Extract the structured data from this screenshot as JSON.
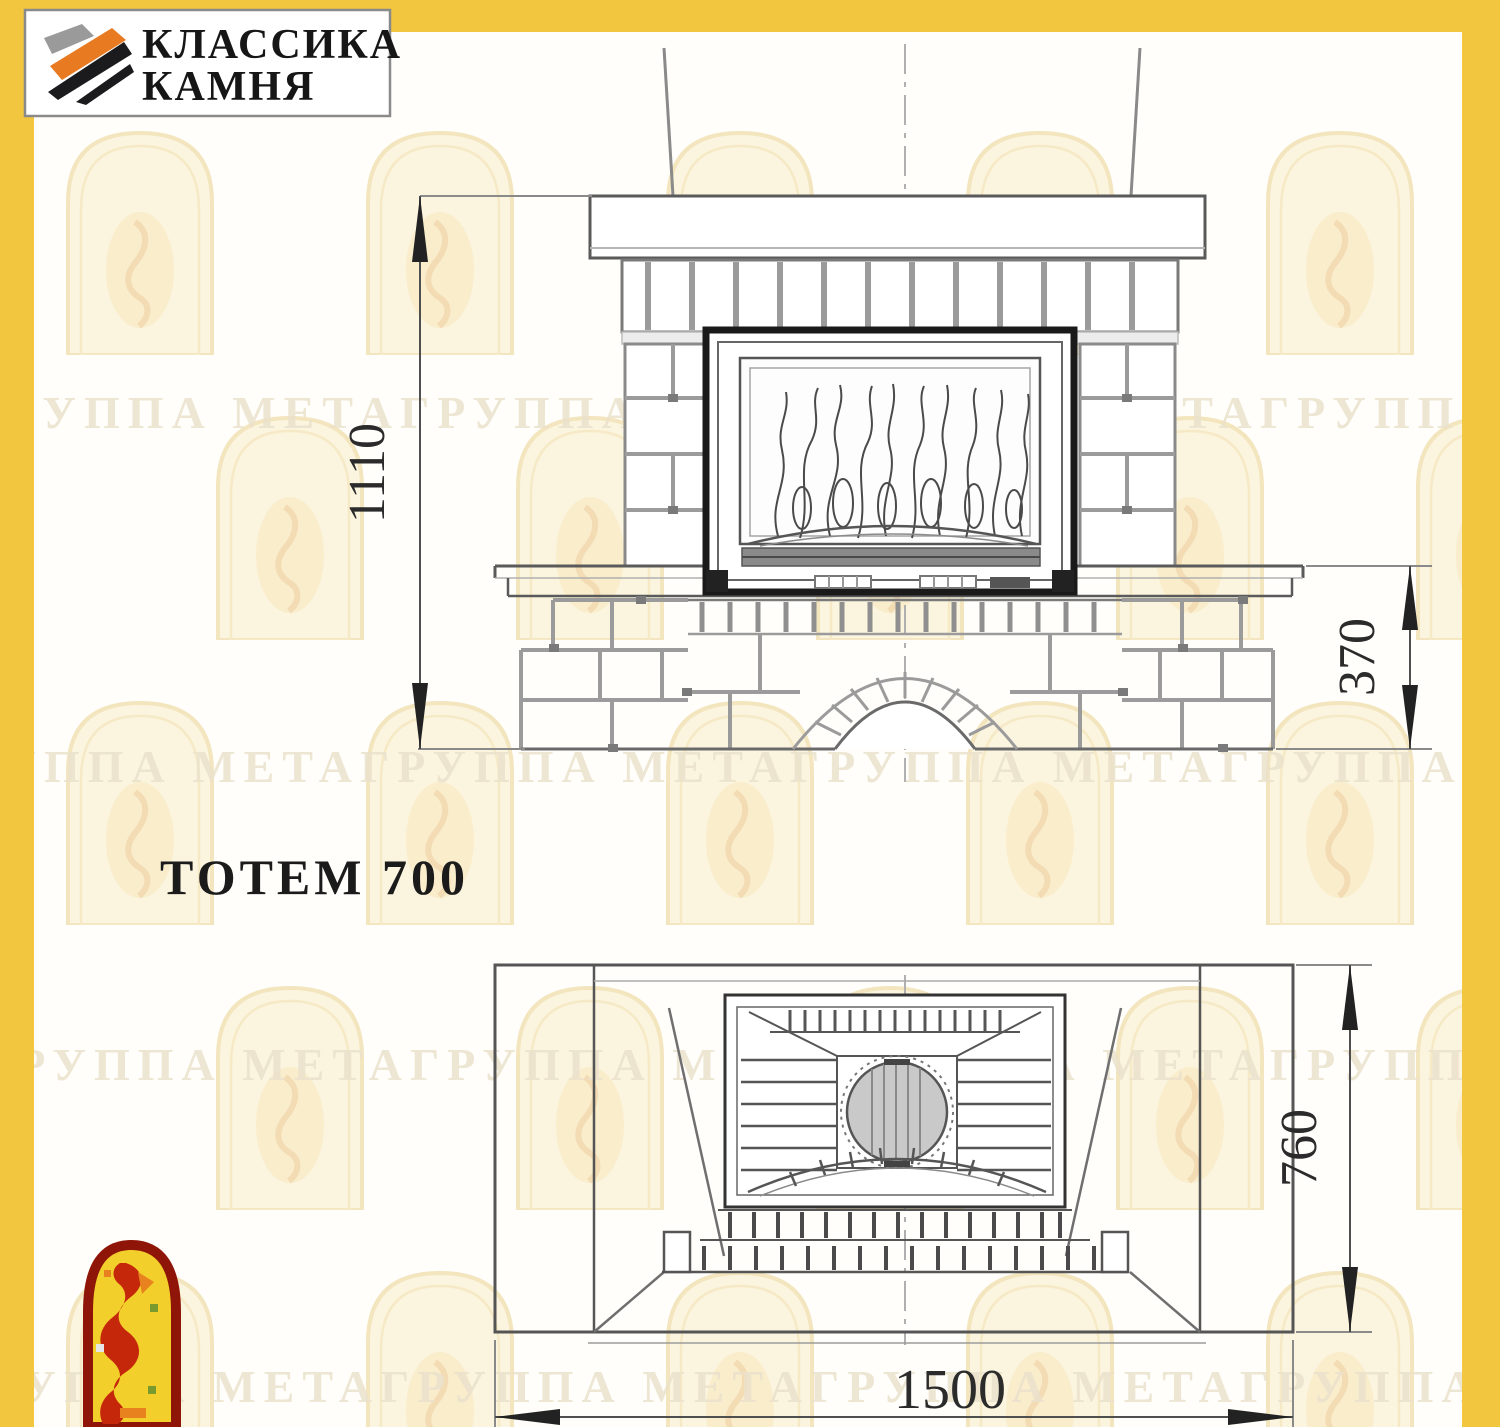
{
  "page": {
    "frame_color": "#F3C63F",
    "background": "#FFFEFB"
  },
  "logo": {
    "line1": "КЛАССИКА",
    "line2": "КАМНЯ"
  },
  "title": "ТОТЕМ 700",
  "front_view": {
    "label_overall_height": "1110",
    "label_plinth_height": "370"
  },
  "plan_view": {
    "label_depth": "760",
    "label_width": "1500"
  },
  "watermark": {
    "text": "ГРУППА МЕТАГРУППА МЕТАГРУППА МЕТАГРУППА МЕТА"
  }
}
